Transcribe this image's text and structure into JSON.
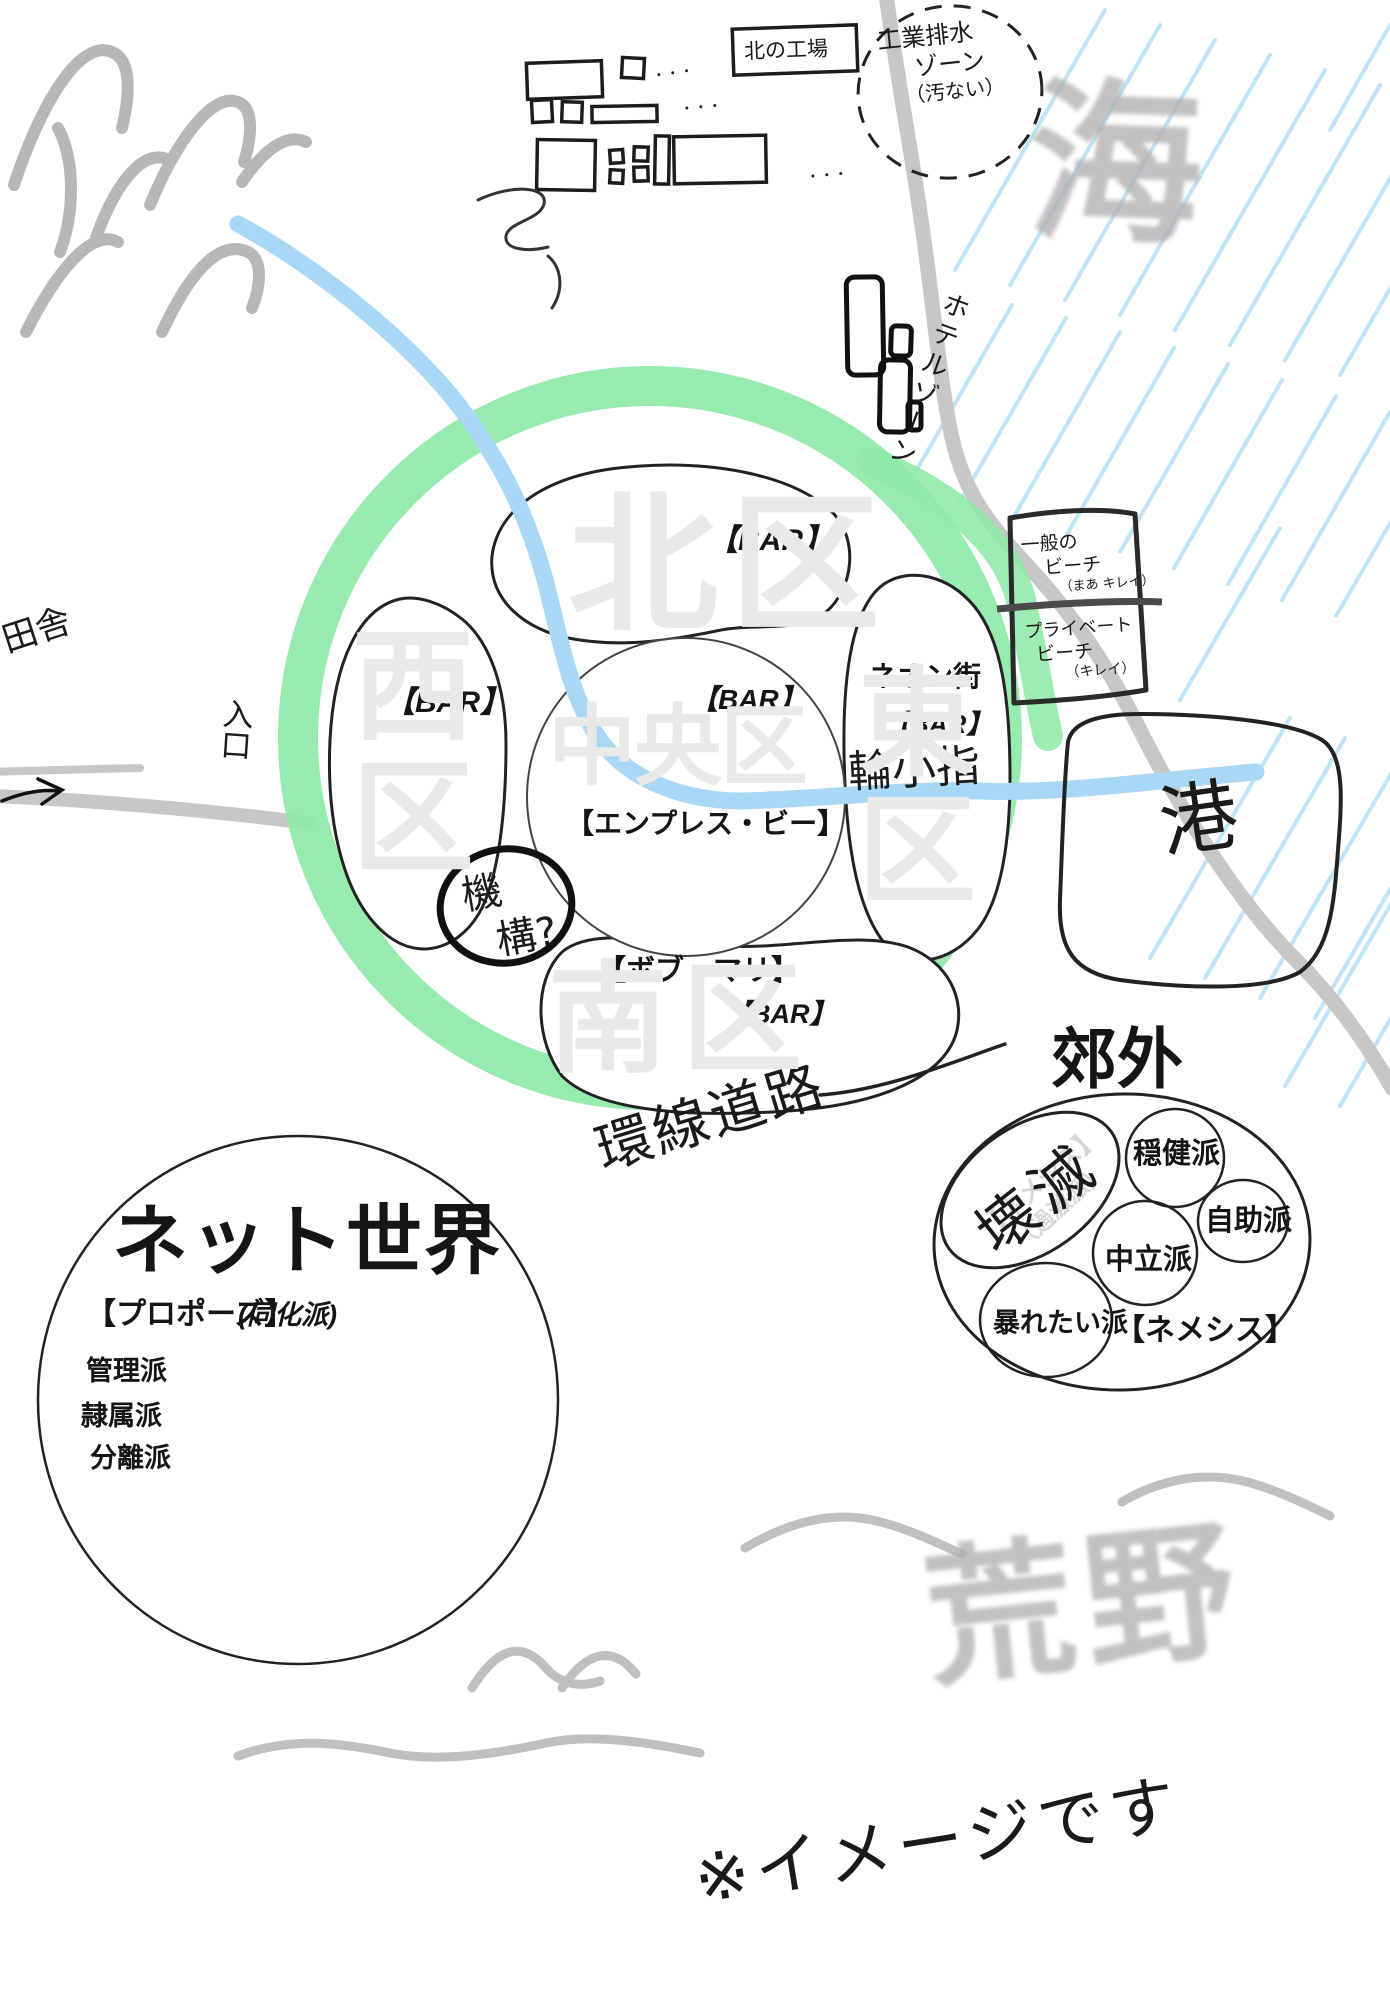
{
  "factory": {
    "label": "北の工場",
    "dots": "・・・"
  },
  "industrial_zone": {
    "line1": "工業排水",
    "line2": "ゾーン",
    "line3": "（汚ない）"
  },
  "sea": "海",
  "hotel_zone": "ホテルゾーン",
  "beach_general": {
    "line1": "一般の",
    "line2": "ビーチ",
    "line3": "（まあ キレイ）"
  },
  "beach_private": {
    "line1": "プライベート",
    "line2": "ビーチ",
    "line3": "（キレイ）"
  },
  "port": "港",
  "countryside": "田舎",
  "entrance": "入口",
  "wards": {
    "north": "北区",
    "west": "西区",
    "central": "中央区",
    "east": "東区",
    "south": "南区"
  },
  "bars": {
    "north": "【BAR】",
    "west": "【BAR】",
    "central": "【BAR】",
    "east": "【BAR】",
    "south": "【BAR】"
  },
  "venues": {
    "central": "【エンプレス・ビー】",
    "south": "【ボブ・マリ】"
  },
  "neon": {
    "district": "ネオン街",
    "note": "輪小指"
  },
  "mystery": {
    "line1": "機",
    "line2": "構?"
  },
  "ring_road": "環線道路",
  "suburbs": {
    "title": "郊外",
    "alliance": "【ネメシス】",
    "destroyed_note": "壊滅",
    "ghost_line1": "【ネメシス】",
    "ghost_line2": "（過激派）",
    "factions": {
      "moderate": "穏健派",
      "self_help": "自助派",
      "neutral": "中立派",
      "rampage": "暴れたい派"
    }
  },
  "net_world": {
    "title": "ネット世界",
    "main": "【プロポーズ】",
    "main_note": "(同化派)",
    "factions": {
      "management": "管理派",
      "servitude": "隷属派",
      "separation": "分離派"
    }
  },
  "wasteland": "荒野",
  "disclaimer": "※イメージです",
  "colors": {
    "ring_green": "#8fe9a7",
    "river_blue": "#a8d8f5",
    "sea_hatch": "#bfe3f8",
    "road_gray": "#c7c7c7",
    "brush_gray": "#b2b2b2",
    "faint_gray": "#e9e9e9"
  }
}
